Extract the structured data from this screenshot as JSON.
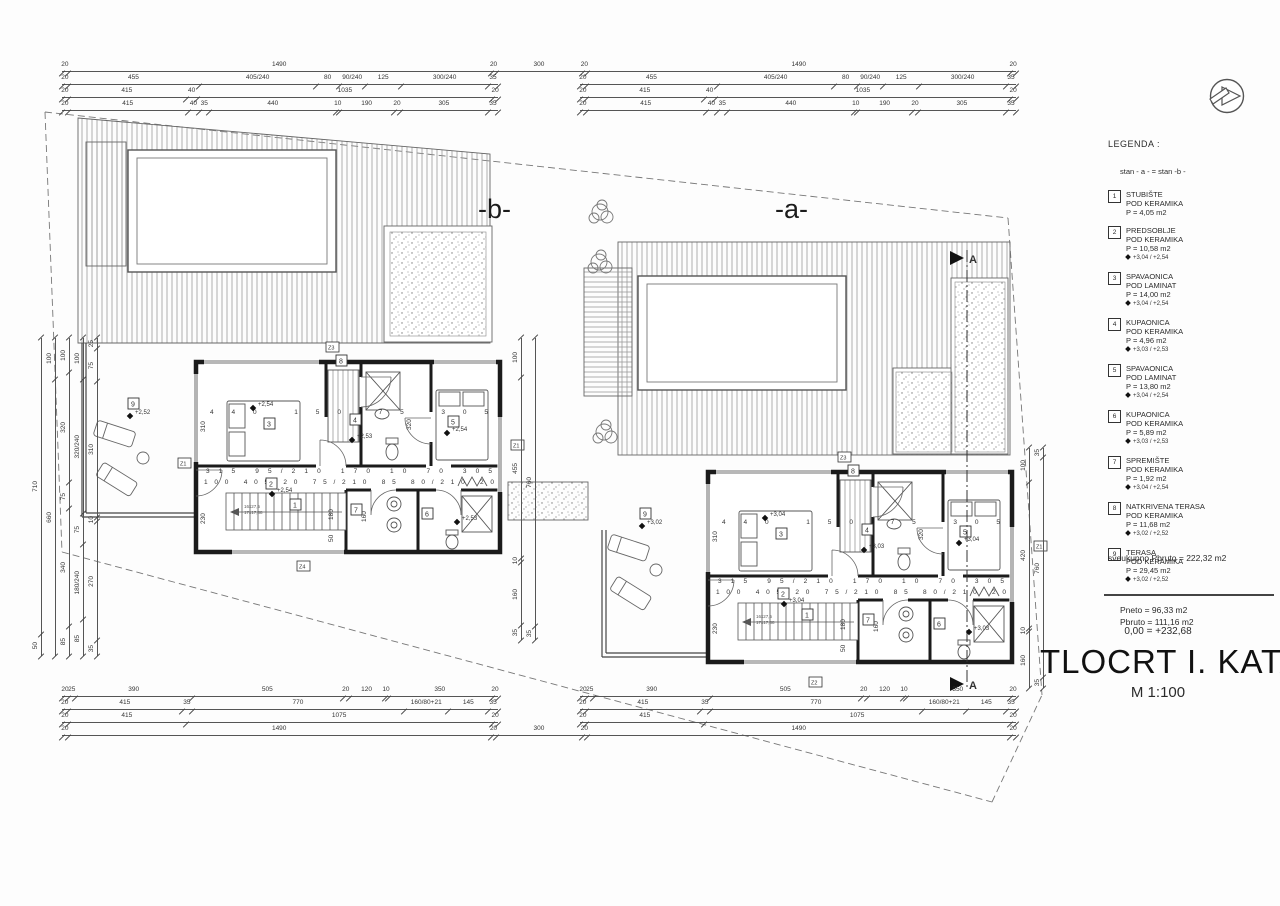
{
  "unit_labels": {
    "a": "-a-",
    "b": "-b-"
  },
  "units": {
    "a": {
      "elev_main": "+3,04",
      "elev_bath": "+3,03",
      "elev_terrace": "+3,02"
    },
    "b": {
      "elev_main": "+2,54",
      "elev_bath": "+2,53",
      "elev_terrace": "+2,52"
    }
  },
  "rooms": {
    "r1": "1",
    "r2": "2",
    "r3": "3",
    "r4": "4",
    "r5": "5",
    "r6": "6",
    "r7": "7",
    "r8": "8",
    "r9": "9"
  },
  "tags": {
    "z1": "Z1",
    "z2": "Z2",
    "z3": "Z3",
    "z4": "Z4"
  },
  "section_marker": {
    "label": "A"
  },
  "stairs": {
    "line1": "16x27,5",
    "line2": "17x17,88"
  },
  "interior": {
    "top": "440 150 75 305",
    "row1": "315 95/210 170 10 70 305",
    "row2": "100 405 20 75/210 85 80/210 20",
    "v310": "310",
    "v320": "320",
    "v230": "230",
    "v180": "180",
    "v160": "160",
    "v50": "50"
  },
  "dims": {
    "top1": [
      "20",
      "1490",
      "20",
      "300",
      "20",
      "1490",
      "20"
    ],
    "top2": [
      "20",
      "455",
      "405/240",
      "80",
      "90/240",
      "125",
      "300/240",
      "35"
    ],
    "top3": [
      "20",
      "415",
      "40",
      "1035",
      "20"
    ],
    "top4": [
      "20",
      "415",
      "40",
      "35",
      "440",
      "10",
      "190",
      "20",
      "305",
      "35"
    ],
    "bot1": [
      "20",
      "25",
      "390",
      "505",
      "20",
      "120",
      "10",
      "350",
      "20"
    ],
    "bot2": [
      "20",
      "415",
      "35",
      "770",
      "160/80+21",
      "145",
      "35"
    ],
    "bot3": [
      "20",
      "415",
      "1075",
      "20"
    ],
    "bot4": [
      "20",
      "1490",
      "20",
      "300",
      "20",
      "1490",
      "20"
    ],
    "left1": [
      "710",
      "50"
    ],
    "left2": [
      "100",
      "660"
    ],
    "left3": [
      "100",
      "320",
      "75",
      "340",
      "85"
    ],
    "left4": [
      "100",
      "320/240",
      "75",
      "180/240",
      "85"
    ],
    "left5": [
      "25",
      "75",
      "310",
      "10",
      "270",
      "35"
    ],
    "mid1": [
      "100",
      "455",
      "10",
      "160",
      "35"
    ],
    "mid2": [
      "760",
      "35"
    ],
    "right1": [
      "100",
      "420",
      "10",
      "160"
    ],
    "right2": [
      "35",
      "760",
      "35"
    ]
  },
  "legend": {
    "title": "LEGENDA :",
    "note": "stan - a - = stan -b -",
    "items": [
      {
        "num": "1",
        "name": "STUBIŠTE",
        "floor": "POD KERAMIKA",
        "area": "P = 4,05 m2",
        "elev": ""
      },
      {
        "num": "2",
        "name": "PREDSOBLJE",
        "floor": "POD KERAMIKA",
        "area": "P = 10,58 m2",
        "elev": "+3,04 / +2,54"
      },
      {
        "num": "3",
        "name": "SPAVAONICA",
        "floor": "POD LAMINAT",
        "area": "P = 14,00 m2",
        "elev": "+3,04 / +2,54"
      },
      {
        "num": "4",
        "name": "KUPAONICA",
        "floor": "POD KERAMIKA",
        "area": "P = 4,96 m2",
        "elev": "+3,03 / +2,53"
      },
      {
        "num": "5",
        "name": "SPAVAONICA",
        "floor": "POD LAMINAT",
        "area": "P = 13,80 m2",
        "elev": "+3,04 / +2,54"
      },
      {
        "num": "6",
        "name": "KUPAONICA",
        "floor": "POD KERAMIKA",
        "area": "P = 5,89 m2",
        "elev": "+3,03 / +2,53"
      },
      {
        "num": "7",
        "name": "SPREMIŠTE",
        "floor": "POD KERAMIKA",
        "area": "P = 1,92 m2",
        "elev": "+3,04 / +2,54"
      },
      {
        "num": "8",
        "name": "NATKRIVENA TERASA",
        "floor": "POD KERAMIKA",
        "area": "P = 11,68 m2",
        "elev": "+3,02 / +2,52"
      },
      {
        "num": "9",
        "name": "TERASA",
        "floor": "POD KERAMIKA",
        "area": "P = 29,45 m2",
        "elev": "+3,02 / +2,52"
      }
    ],
    "pneto": "Pneto = 96,33 m2",
    "pbruto": "Pbruto = 111,16 m2",
    "total": "sveukupno Pbruto = 222,32 m2"
  },
  "title_block": {
    "datum": "0,00 = +232,68",
    "title": "TLOCRT I. KATA",
    "scale": "M 1:100"
  }
}
